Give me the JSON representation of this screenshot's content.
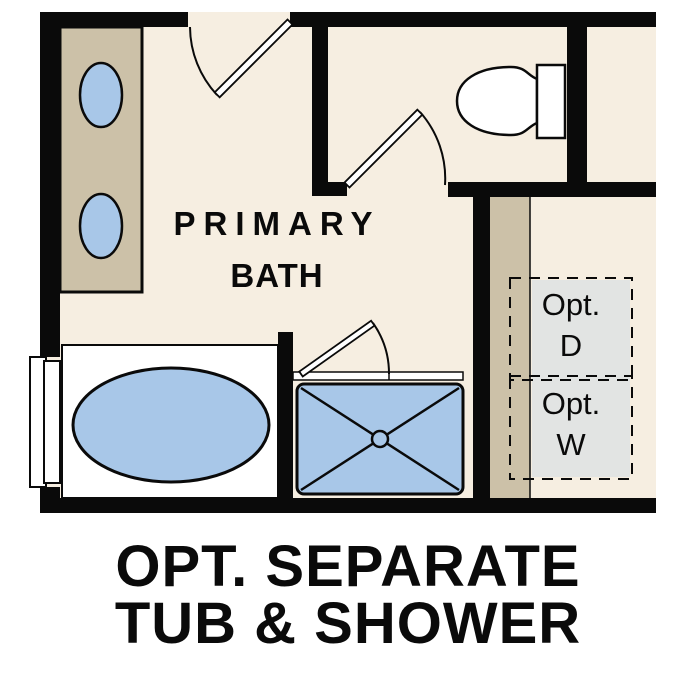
{
  "caption": {
    "line1": "OPT. SEPARATE",
    "line2": "TUB & SHOWER"
  },
  "plan": {
    "room_label": {
      "line1": "PRIMARY",
      "line2": "BATH"
    },
    "optional_dryer": {
      "line1": "Opt.",
      "line2": "D"
    },
    "optional_washer": {
      "line1": "Opt.",
      "line2": "W"
    }
  },
  "colors": {
    "background": "#ffffff",
    "floor": "#f6eee1",
    "cabinet": "#ccc1a8",
    "fixture_blue": "#a8c7e8",
    "appliance_gray": "#e2e4e3",
    "wall": "#0a0a0a",
    "line": "#0a0a0a"
  }
}
